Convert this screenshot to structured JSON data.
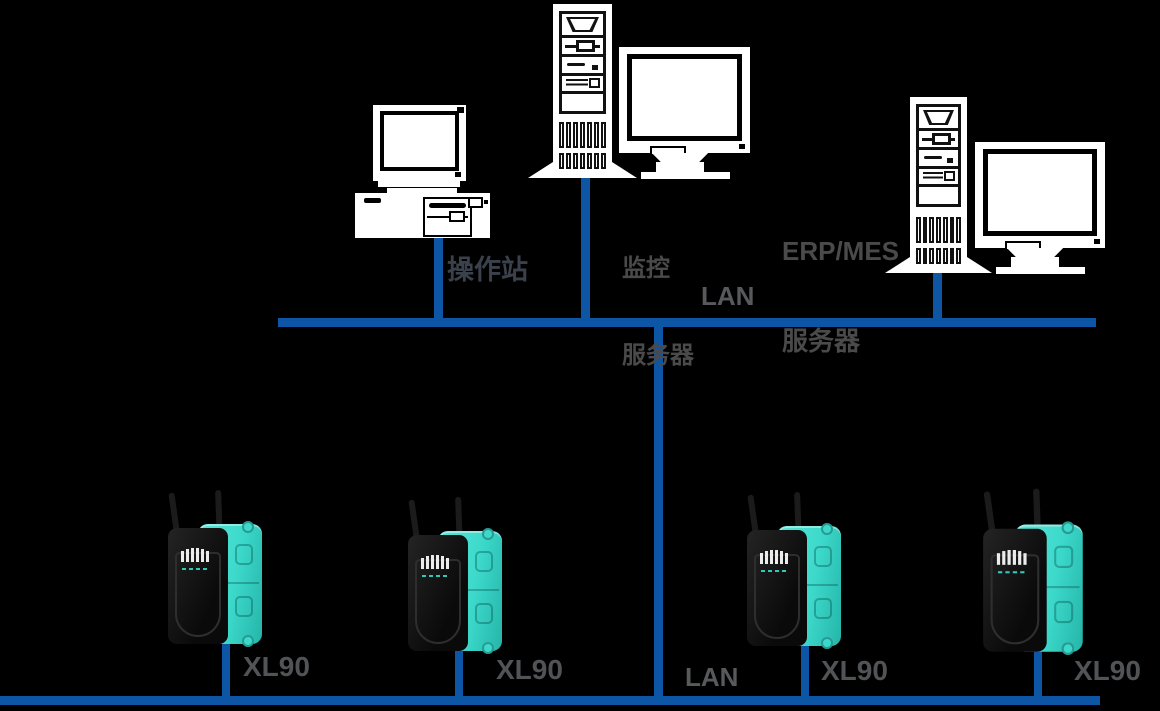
{
  "diagram": {
    "type": "network-topology",
    "colors": {
      "background": "#000000",
      "bus_line": "#0D55A5",
      "device_accent_teal": "#3CD9CB",
      "label_dark_gray": "#3A414B",
      "label_gray": "#4A4A4A",
      "label_lan_gray": "#58595B"
    },
    "labels": {
      "workstation": "操作站",
      "monitoring_server_line1": "监控",
      "monitoring_server_line2": "服务器",
      "erp_server_line1": "ERP/MES",
      "erp_server_line2": "服务器",
      "lan_top": "LAN",
      "lan_bottom": "LAN"
    },
    "devices": [
      {
        "label": "XL90"
      },
      {
        "label": "XL90"
      },
      {
        "label": "XL90"
      },
      {
        "label": "XL90"
      }
    ]
  }
}
